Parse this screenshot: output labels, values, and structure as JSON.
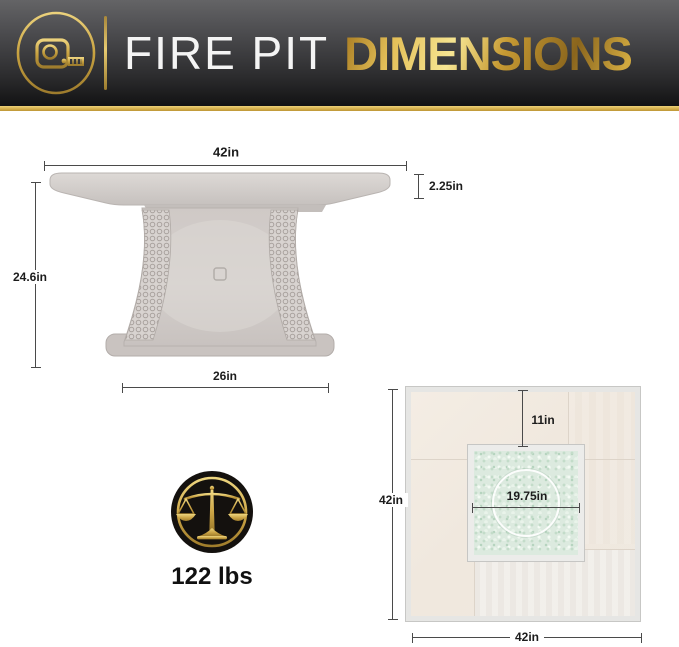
{
  "header": {
    "title_light": "FIRE PIT",
    "title_accent": "DIMENSIONS",
    "logo_icon": "tape-measure-icon",
    "colors": {
      "gold": "#d3ad49",
      "banner_dark": "#121213"
    }
  },
  "side_view": {
    "labels": {
      "top_width": "42in",
      "top_thickness": "2.25in",
      "height": "24.6in",
      "base_width": "26in"
    }
  },
  "weight": {
    "icon": "balance-scale-icon",
    "value": "122 lbs"
  },
  "top_view": {
    "labels": {
      "edge_to_insert": "11in",
      "side_height": "42in",
      "burner_diameter": "19.75in",
      "side_width": "42in"
    }
  }
}
